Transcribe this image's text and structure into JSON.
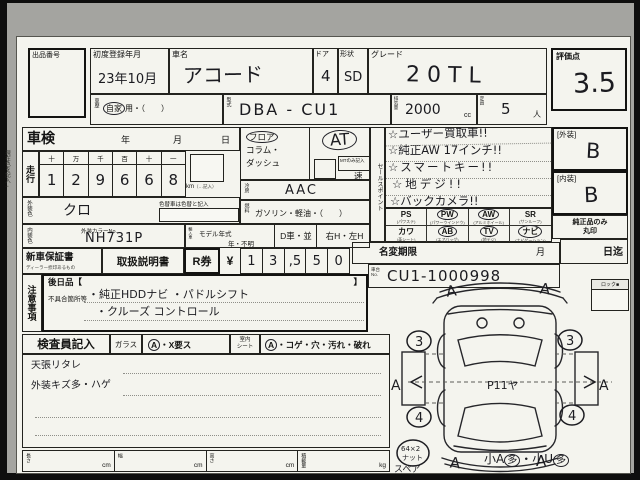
{
  "top": {
    "auction_no_label": "出品番号",
    "first_reg_label": "初度登録年月",
    "first_reg_value": "23年10月",
    "car_name_label": "車名",
    "car_name_value": "アコード",
    "door_label": "ドア",
    "door_value": "4",
    "shape_label": "形状",
    "shape_value": "SD",
    "grade_label": "グレード",
    "grade_value": "20TL",
    "score_label": "評価点",
    "score_value": "3.5",
    "history_label": "車歴",
    "history_circled": "自家",
    "history_rest": "用・（　　）",
    "model_code_label": "型式",
    "model_code_value": "DBA - CU1",
    "displacement_label": "排気量",
    "displacement_value": "2000",
    "displacement_unit": "cc",
    "capacity_label": "定員",
    "capacity_value": "5",
    "capacity_unit": "人"
  },
  "shaken": {
    "label": "車検",
    "year_label": "年",
    "month_label": "月",
    "day_label": "日"
  },
  "mileage": {
    "label": "走行",
    "headers": [
      "十",
      "万",
      "千",
      "百",
      "十",
      "一"
    ],
    "digits": [
      "1",
      "2",
      "9",
      "6",
      "6",
      "8"
    ],
    "unit": "km",
    "unit_note": "（…記入）"
  },
  "colors": {
    "ext_label": "外装色",
    "ext_value": "クロ",
    "change_note": "色替車は色替と記入",
    "int_label": "内装色",
    "color_no_label": "外装カラーNo.",
    "color_no_value": "NH731P",
    "margin_note": "現在色を記入→"
  },
  "shift": {
    "opt1": "フロア",
    "opt2": "コラム・",
    "opt3": "ダッシュ",
    "at_value": "AT",
    "mt_note": "MTのみ記入",
    "speed_label": "速"
  },
  "climate": {
    "ac_label": "冷房",
    "ac_value": "AAC",
    "fuel_label": "燃料",
    "fuel_value": "ガソリン・軽油・（　　）"
  },
  "modelyear": {
    "import_label": "輸入車",
    "label": "モデル年式",
    "value": "年・不明",
    "dealer": "D車・並",
    "handle": "右H・左H"
  },
  "sales": {
    "label": "セールスポイント",
    "lines": [
      "☆ユーザー買取車!!",
      "☆純正AW 17インチ!!",
      "☆スマートキー!!",
      "☆地デジ!!",
      "☆バックカメラ!!"
    ]
  },
  "equipment": {
    "items": [
      {
        "code": "PS",
        "name": "(パワステ)",
        "circled": false
      },
      {
        "code": "PW",
        "name": "(パワーウインドウ)",
        "circled": true
      },
      {
        "code": "AW",
        "name": "(アルミホイール)",
        "circled": true
      },
      {
        "code": "SR",
        "name": "(サンルーフ)",
        "circled": false
      },
      {
        "code": "カワ",
        "name": "(革シート)",
        "circled": false
      },
      {
        "code": "AB",
        "name": "(エアバッグ)",
        "circled": true
      },
      {
        "code": "TV",
        "name": "(地デジ)",
        "circled": true
      },
      {
        "code": "ナビ",
        "name": "(ナビゲーション)",
        "circled": true
      }
    ]
  },
  "ratings": {
    "ext_label": "[外装]",
    "ext_value": "B",
    "int_label": "[内装]",
    "int_value": "B",
    "genuine_note1": "純正品のみ",
    "genuine_note2": "丸印",
    "until_label": "日迄"
  },
  "docs": {
    "warranty": "新車保証書",
    "warranty_sub": "ディーラー捺印あるもの",
    "manual": "取扱説明書",
    "rticket": "R券",
    "yen": "¥",
    "digits": [
      "1",
      "3",
      ",5",
      "5",
      "0"
    ],
    "namechange": "名変期限",
    "month": "月"
  },
  "chassis": {
    "label1": "車台",
    "label2": "No.",
    "value": "CU1-1000998"
  },
  "notes": {
    "label": "注意事項",
    "later": "後日品【",
    "later_close": "】",
    "defects_label": "不具合箇所等",
    "line1": "・純正HDDナビ ・パドルシフト",
    "line2": "・クルーズ コントロール"
  },
  "inspector": {
    "label": "検査員記入",
    "glass_label": "ガラス",
    "glass_mark": "A",
    "glass_rest": "・X要ス",
    "seat_label1": "室内",
    "seat_label2": "シート",
    "seat_mark": "A",
    "seat_rest": "・コゲ・穴・汚れ・破れ",
    "note1": "天張リタレ",
    "note2": "外装キズ多・ハゲ"
  },
  "dims": {
    "length_label": "長さ",
    "width_label": "幅",
    "height_label": "高さ",
    "load_label": "積載量",
    "cm": "cm",
    "kg": "kg"
  },
  "diagram": {
    "lock_label": "ロック■",
    "mark_a": "A",
    "front_wheel": "3",
    "rear_wheel": "4",
    "roof_note": "P11ヤ",
    "spare_label": "スペア",
    "wheel_note1": "64×2",
    "wheel_note2": "ナット",
    "summary1": "小A",
    "summary2": "多",
    "summary3": "・小U",
    "summary4": "多"
  }
}
